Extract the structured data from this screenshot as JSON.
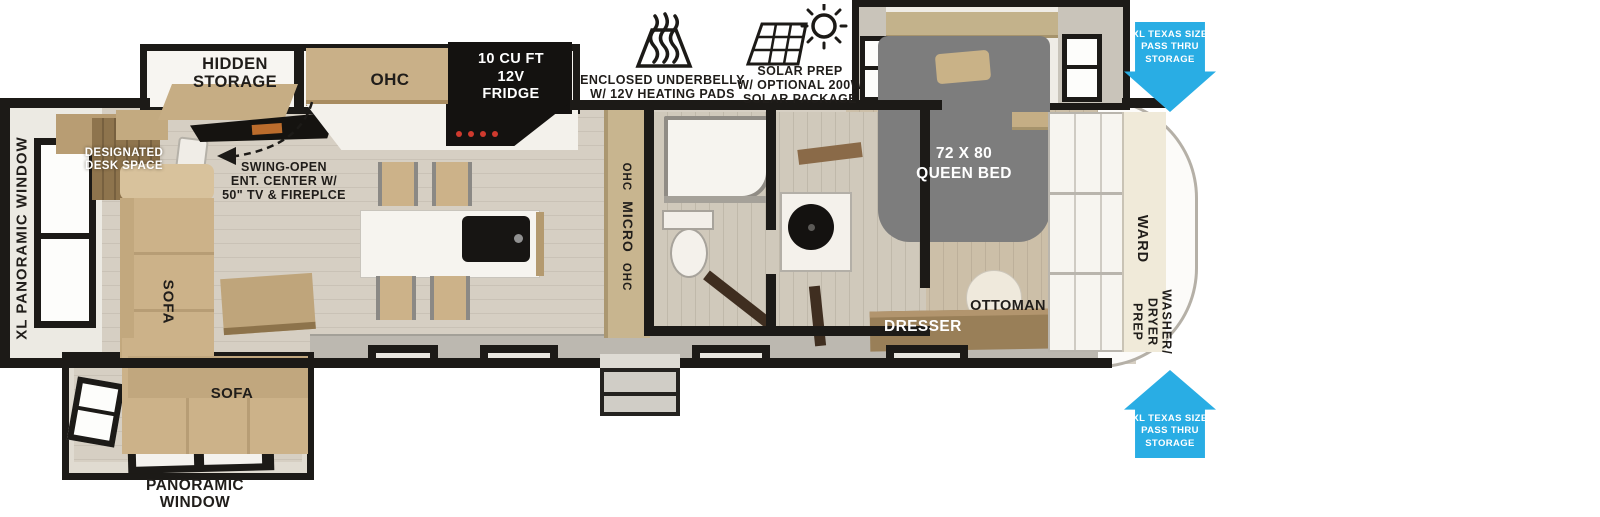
{
  "colors": {
    "wall": "#1c1a17",
    "arrow_blue": "#29ade4",
    "floor_main": "#d6cfc3",
    "floor_bedroom": "#ccbfa8",
    "sofa_tan": "#ccb289",
    "wood_light": "#c9b088",
    "wood_dark": "#8e744d",
    "bed_gray": "#7d7d7d",
    "appliance_black": "#141210"
  },
  "callouts": {
    "underbelly": {
      "icon": "heating-pads-icon",
      "lines": [
        "ENCLOSED UNDERBELLY",
        "W/ 12V HEATING PADS"
      ]
    },
    "solar": {
      "icon": "solar-prep-icon",
      "lines": [
        "SOLAR PREP",
        "W/ OPTIONAL 200W",
        "SOLAR PACKAGE"
      ]
    },
    "pass_thru_top": {
      "lines": [
        "XL TEXAS SIZE",
        "PASS THRU",
        "STORAGE"
      ]
    },
    "pass_thru_bottom": {
      "lines": [
        "XL TEXAS SIZE",
        "PASS THRU",
        "STORAGE"
      ]
    },
    "ent_center": {
      "lines": [
        "SWING-OPEN",
        "ENT. CENTER W/",
        "50\" TV & FIREPLCE"
      ]
    }
  },
  "living": {
    "hidden_storage": "HIDDEN STORAGE",
    "ohc": "OHC",
    "desk": {
      "lines": [
        "DESIGNATED",
        "DESK SPACE"
      ]
    },
    "sofa_side": "SOFA",
    "sofa_rear": "SOFA",
    "xl_panoramic_window": "XL PANORAMIC WINDOW",
    "panoramic_window": {
      "lines": [
        "PANORAMIC",
        "WINDOW"
      ]
    }
  },
  "kitchen": {
    "fridge": {
      "lines": [
        "10 CU FT",
        "12V",
        "FRIDGE"
      ]
    },
    "pantry": {
      "segments": [
        "OHC",
        "MICRO",
        "OHC"
      ]
    }
  },
  "bedroom": {
    "bed": {
      "lines": [
        "72 X 80",
        "QUEEN BED"
      ]
    },
    "dresser": "DRESSER",
    "ottoman": "OTTOMAN",
    "ward": "WARD",
    "washer_dryer": {
      "lines": [
        "WASHER/",
        "DRYER",
        "PREP"
      ]
    }
  }
}
